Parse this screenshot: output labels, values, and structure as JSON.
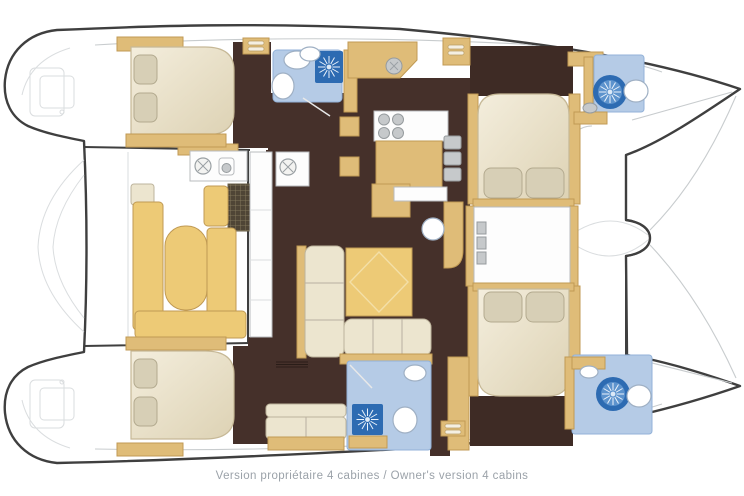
{
  "caption": {
    "text": "Version propriétaire 4 cabines / Owner's version 4 cabins",
    "text_fr": "Version propriétaire 4 cabines",
    "text_en": "Owner's version 4 cabins",
    "cabin_count": "4"
  },
  "drawing": {
    "type": "catamaran-floor-plan",
    "orientation": "bows-right"
  },
  "colors": {
    "outline": "#3f3f3f",
    "deck_line_gray": "#c8ccce",
    "floor_dark": "#45302a",
    "wood_tan": "#dfbc78",
    "wood_tan_edge": "#c09a54",
    "wood_tan_light": "#edca76",
    "upholstery_cream": "#ece5cf",
    "pillow_beige": "#d7cfb6",
    "bath_floor_blue": "#b5cbe6",
    "shower_blue": "#2d6bb2",
    "caption_gray": "#9ba2a9"
  }
}
